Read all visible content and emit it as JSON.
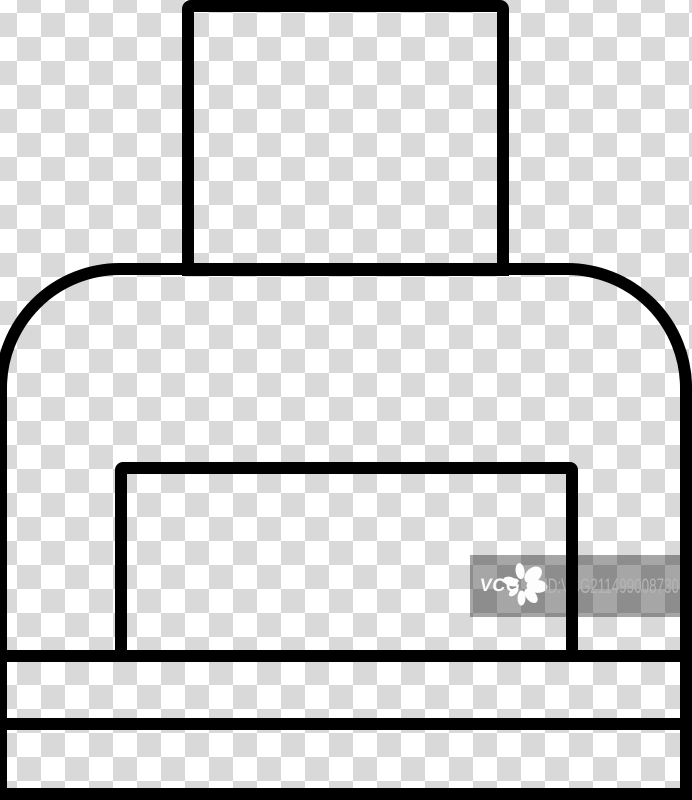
{
  "image": {
    "kind": "stock line icon preview",
    "subject": "printer icon, thin black outline style, on transparent checkerboard background",
    "icon_parts": [
      "printer-paper-sheet",
      "printer-body",
      "printer-output-tray",
      "printer-detail-line-upper",
      "printer-detail-line-lower"
    ]
  },
  "watermark": {
    "logo_text": "VCG",
    "flower_icon": "vcg-flower-starburst-icon",
    "id_text": "ID:VCG211499008730"
  },
  "colors": {
    "icon_line": "#000000",
    "checker_light": "#ffffff",
    "checker_dark": "#d9d9d9",
    "watermark_overlay": "rgba(0,0,0,0.35)",
    "watermark_logo": "#fbfbfb",
    "watermark_id_text": "#b4b4b4"
  }
}
